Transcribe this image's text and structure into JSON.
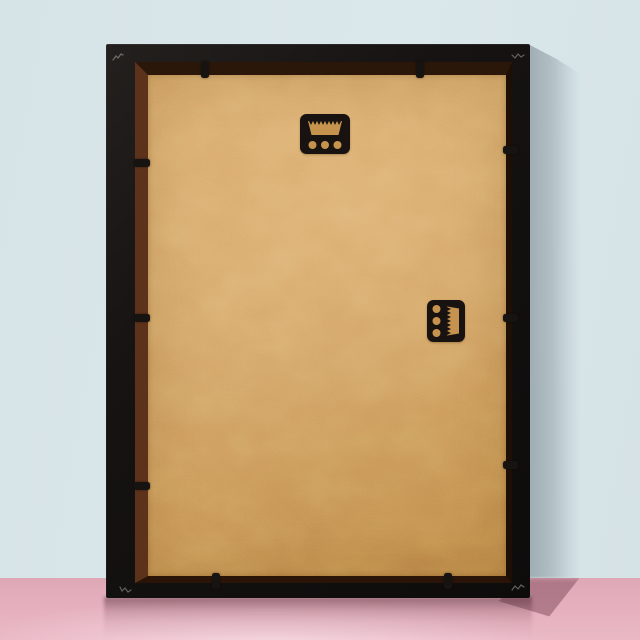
{
  "scene": {
    "subject": "Back view of an empty black picture frame with a tan MDF backing board, standing on a pink surface against a pale blue wall",
    "wall": {
      "label": "pale blue wall"
    },
    "floor": {
      "label": "pink glossy surface"
    },
    "frame": {
      "label": "black frame, portrait orientation",
      "backing": "kraft/MDF backing board"
    },
    "hardware": {
      "top_hanger": {
        "label": "sawtooth hanger, top center",
        "holes": 3
      },
      "side_hanger": {
        "label": "sawtooth hanger, right middle (landscape hanging)",
        "holes": 3
      },
      "retaining_tabs": {
        "top": 2,
        "bottom": 2,
        "left": 3,
        "right": 3,
        "total": 10
      }
    },
    "lighting": {
      "cast_shadow": "to the right of the frame on wall and floor"
    },
    "colors": {
      "wall": "#d9e6e9",
      "wall_shadow": "#93a2aa",
      "floor": "#e4aebc",
      "floor_shadow": "#82505f",
      "frame_black": "#161312",
      "rabbet_brown": "#5d321b",
      "board_tan": "#d2a164",
      "hardware_black": "#181310",
      "hardware_cutout": "#c6934f"
    }
  }
}
